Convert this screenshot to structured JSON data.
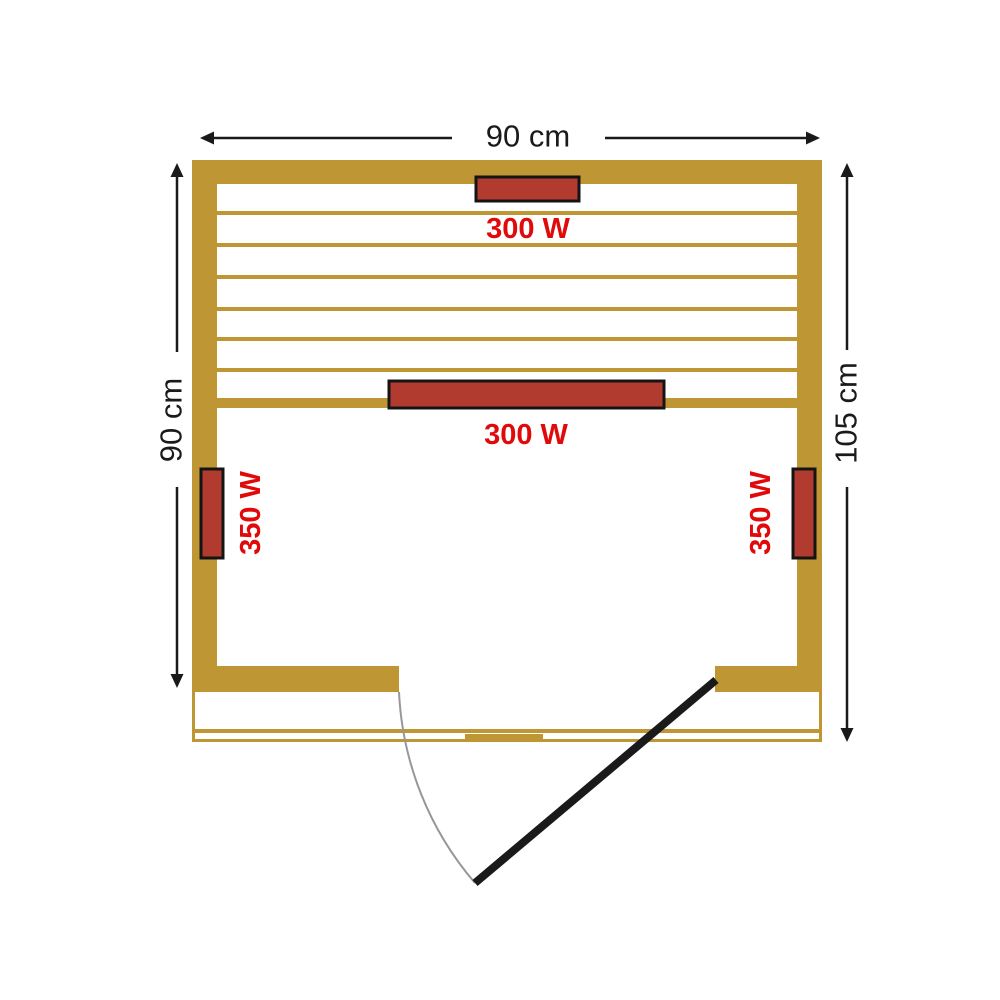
{
  "colors": {
    "background": "#FFFFFF",
    "wall": "#BE9633",
    "heater": "#B23B2F",
    "heater-outline": "#141414",
    "label-red": "#E10A0A",
    "line": "#1A1A1A",
    "door": "#1A1A1A",
    "arc": "#979797"
  },
  "dimensions": {
    "width": {
      "label": "90 cm"
    },
    "left_height": {
      "label": "90 cm"
    },
    "right_height": {
      "label": "105 cm"
    }
  },
  "heaters": {
    "top": {
      "label": "300 W"
    },
    "middle": {
      "label": "300 W"
    },
    "left": {
      "label": "350 W"
    },
    "right": {
      "label": "350 W"
    }
  }
}
